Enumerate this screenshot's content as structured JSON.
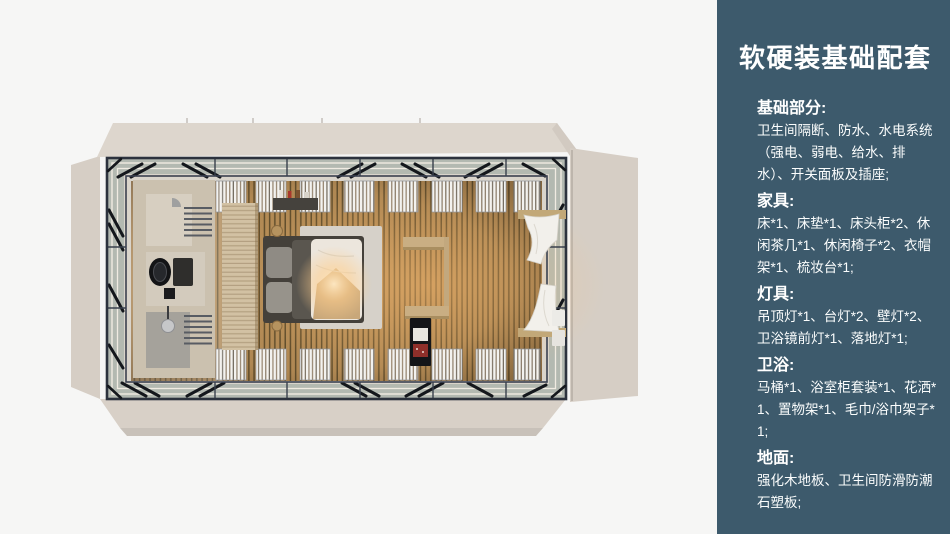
{
  "canvas": {
    "width": 950,
    "height": 534,
    "background": "#f6f6f5"
  },
  "panel": {
    "bg_color": "#3d5a6c",
    "text_color": "#ffffff",
    "title": "软硬装基础配套",
    "sections": [
      {
        "heading": "基础部分:",
        "body": "卫生间隔断、防水、水电系统（强电、弱电、给水、排水）、开关面板及插座;"
      },
      {
        "heading": "家具:",
        "body": "床*1、床垫*1、床头柜*2、休闲茶几*1、休闲椅子*2、衣帽架*1、梳妆台*1;"
      },
      {
        "heading": "灯具:",
        "body": "吊顶灯*1、台灯*2、壁灯*2、卫浴镜前灯*1、落地灯*1;"
      },
      {
        "heading": "卫浴:",
        "body": "马桶*1、浴室柜套装*1、花洒*1、置物架*1、毛巾/浴巾架子*1;"
      },
      {
        "heading": "地面:",
        "body": "强化木地板、卫生间防滑防潮石塑板;"
      }
    ]
  },
  "floorplan": {
    "type": "top-down-room-render",
    "elements": [
      "roof-panel",
      "left-wall-panel",
      "right-wall-panel",
      "bottom-wall-panel",
      "steel-frame",
      "truss-braces",
      "white-rails",
      "window-blinds",
      "bathroom",
      "vanity-sink",
      "towel-rails",
      "shower-head",
      "wardrobe-partition",
      "double-bed",
      "pillows",
      "duvet",
      "blanket",
      "bed-rug",
      "wall-shelf",
      "storage-baskets",
      "side-shelves",
      "minibar-cabinet",
      "window-curtains",
      "window-beams",
      "wood-slat-floor",
      "warm-ceiling-light"
    ],
    "colors": {
      "shell": "#ddd6cd",
      "frame": "#2c323d",
      "glass_band": "#b3b9b1",
      "floor_light": "#bb9159",
      "floor_dark": "#66522f",
      "warm_glow": "#ffbe72",
      "bathroom_wall": "#cbc1af",
      "rug": "#d6d1c9",
      "duvet": "#ece6dd",
      "blanket": "#c8a77a",
      "curtain": "#f2f0eb"
    }
  }
}
